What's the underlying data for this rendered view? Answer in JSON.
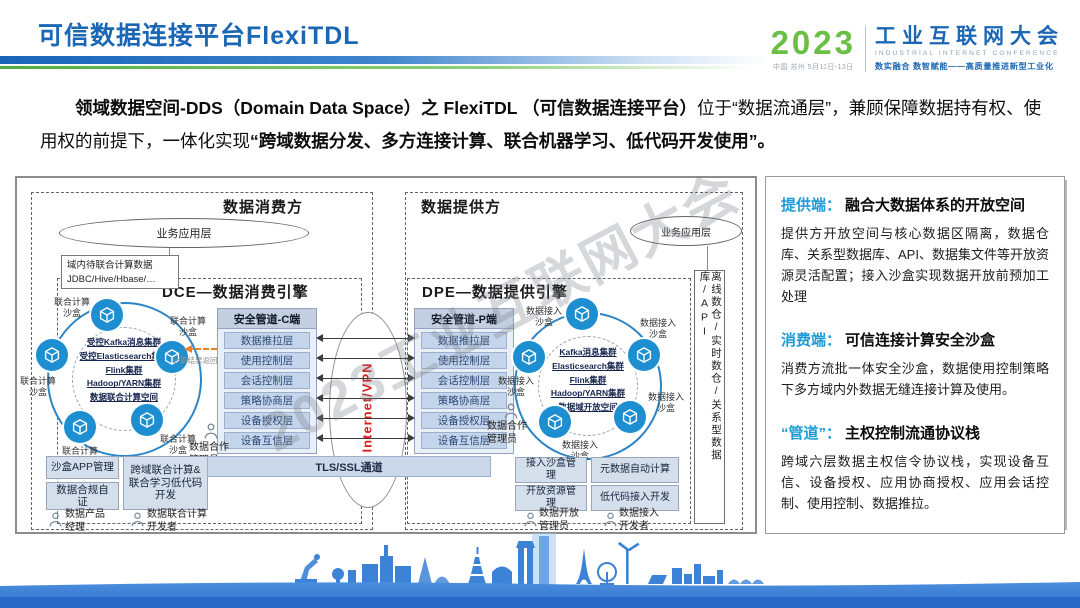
{
  "header": {
    "title": "可信数据连接平台FlexiTDL",
    "logo": {
      "year": "2023",
      "venue": "中国·苏州 5月11日-13日",
      "name_cn": "工业互联网大会",
      "name_en": "INDUSTRIAL INTERNET CONFERENCE",
      "slogan": "数实融合 数智赋能——高质量推进新型工业化"
    }
  },
  "intro": {
    "bold_lead": "领域数据空间-DDS（Domain Data Space）之 FlexiTDL （可信数据连接平台）",
    "normal_mid": "位于“数据流通层”，兼顾保障数据持有权、使用权的前提下，一体化实现",
    "bold_tail": "“跨域数据分发、多方连接计算、联合机器学习、低代码开发使用”。"
  },
  "diagram": {
    "watermark": "2023工业互联网大会",
    "network_label": "Internet/VPN",
    "tls_channel": "TLS/SSL通道",
    "pipe_layers": [
      "数据推拉层",
      "使用控制层",
      "会话控制层",
      "策略协商层",
      "设备授权层",
      "设备互信层"
    ],
    "consumer": {
      "zone": "数据消费方",
      "app_layer": "业务应用层",
      "datasource_line1": "域内待联合计算数据",
      "datasource_line2": "JDBC/Hive/Hbase/…",
      "engine": "DCE—数据消费引擎",
      "pipe_title": "安全管道-C端",
      "sandbox": "联合计算沙盒",
      "clusters": [
        "受控Kafka消息集群",
        "受控Elasticsearch集群",
        "Flink集群",
        "Hadoop/YARN集群",
        "数据联合计算空间"
      ],
      "arrow_note": "计算结果返回",
      "admin": "数据合作管理员",
      "boxes": [
        "沙盒APP管理",
        "数据合规自证",
        "跨域联合计算&联合学习低代码开发"
      ],
      "roles": [
        "数据产品经理",
        "数据联合计算开发者"
      ]
    },
    "provider": {
      "zone": "数据提供方",
      "app_layer": "业务应用层",
      "engine": "DPE—数据提供引擎",
      "pipe_title": "安全管道-P端",
      "sandbox": "数据接入沙盒",
      "clusters": [
        "Kafka消息集群",
        "Elasticsearch集群",
        "Flink集群",
        "Hadoop/YARN集群",
        "数据域开放空间"
      ],
      "admin": "数据合作管理员",
      "datastore": "离线数仓/实时数仓/关系型数据库/API",
      "boxes": [
        "接入沙盒管理",
        "开放资源管理",
        "元数据自动计算",
        "低代码接入开发"
      ],
      "roles": [
        "数据开放管理员",
        "数据接入开发者"
      ]
    }
  },
  "panel": {
    "sections": [
      {
        "tag": "提供端：",
        "title": "融合大数据体系的开放空间",
        "body": "提供方开放空间与核心数据区隔离，数据仓库、关系型数据库、API、数据集文件等开放资源灵活配置；接入沙盒实现数据开放前预加工处理"
      },
      {
        "tag": "消费端：",
        "title": "可信连接计算安全沙盒",
        "body": "消费方流批一体安全沙盒，数据使用控制策略下多方域内外数据无缝连接计算及使用。"
      },
      {
        "tag": "“管道”：",
        "title": "主权控制流通协议栈",
        "body": "跨域六层数据主权信令协议栈，实现设备互信、设备授权、应用协商授权、应用会话控制、使用控制、数据推拉。"
      }
    ]
  },
  "colors": {
    "title_blue": "#1b67b4",
    "green": "#5cb947",
    "panel_tag_blue": "#1f9bd7",
    "node_blue": "#1d8fd1",
    "network_red": "#e01b1b",
    "skyline_blue": "#3c82d6"
  }
}
